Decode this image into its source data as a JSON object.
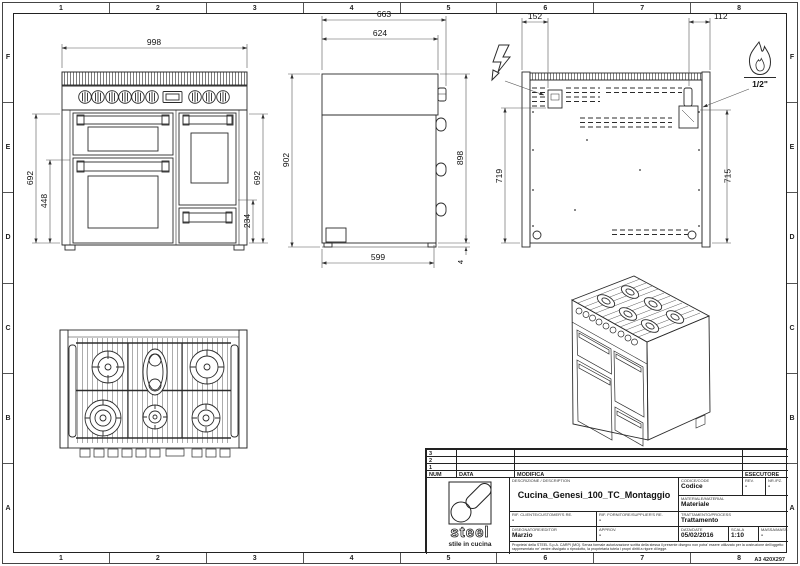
{
  "sheet": {
    "grid_columns": [
      "1",
      "2",
      "3",
      "4",
      "5",
      "6",
      "7",
      "8"
    ],
    "grid_rows": [
      "F",
      "E",
      "D",
      "C",
      "B",
      "A"
    ],
    "format": "A3 420X297"
  },
  "dimensions": {
    "front": {
      "width": "998",
      "height_left": "692",
      "height_inner": "448",
      "height_right": "692",
      "height_lower": "234",
      "height_total": "902"
    },
    "side": {
      "depth_total": "663",
      "depth_top": "624",
      "height_body": "898",
      "depth_base": "599",
      "foot_gap": "4"
    },
    "rear": {
      "electric_offset": "152",
      "gas_offset": "112",
      "electric_height": "719",
      "gas_height": "715",
      "gas_thread": "1/2\""
    }
  },
  "title_block": {
    "revisions": [
      "3",
      "2",
      "1"
    ],
    "rev_headers": {
      "num": "NUM",
      "date": "DATA",
      "modifica": "MODIFICA",
      "esecutore": "ESECUTORE"
    },
    "logo_text": "steel",
    "logo_tagline": "stile in cucina",
    "description_label": "DESCRIZIONE / DESCRIPTION",
    "description": "Cucina_Genesi_100_TC_Montaggio",
    "codice_label": "CODICE/CODE",
    "codice": "Codice",
    "rev_label": "REV.",
    "rev": "-",
    "nrpz_label": "NR./PZ.",
    "nrpz": "-",
    "materiale_label": "MATERIALE/MATERIAL",
    "materiale": "Materiale",
    "rif_cliente_label": "RIF. CLIENTE/CUSTOMER'S RE.",
    "rif_cliente": "-",
    "rif_fornitore_label": "RIF. FORNITORE/SUPPLIER'S RE.",
    "rif_fornitore": "-",
    "trattamento_label": "TRATTAMENTO/PROCESS",
    "trattamento": "Trattamento",
    "disegnatore_label": "DISEGNATORE/EDITOR",
    "disegnatore": "Marzio",
    "approv_label": "APPROV.",
    "approv": "-",
    "data_label": "DATA/DATE",
    "data": "05/02/2016",
    "scala_label": "SCALA",
    "scala": "1:10",
    "massa_label": "MASSA/MASS kg",
    "massa": "-",
    "disclaimer": "Proprieta' della STEEL S.p.A. CARPI (MO). Senza formale autorizzazione scritta della stessa il presente disegno non potra' essere utilizzato per la costruzione dell'oggetto rappresentato ne' venire divulgato o riprodotto, la proprietaria tutela i propri diritti a rigore di legge.",
    "sheet_format": "A3 420X297"
  }
}
